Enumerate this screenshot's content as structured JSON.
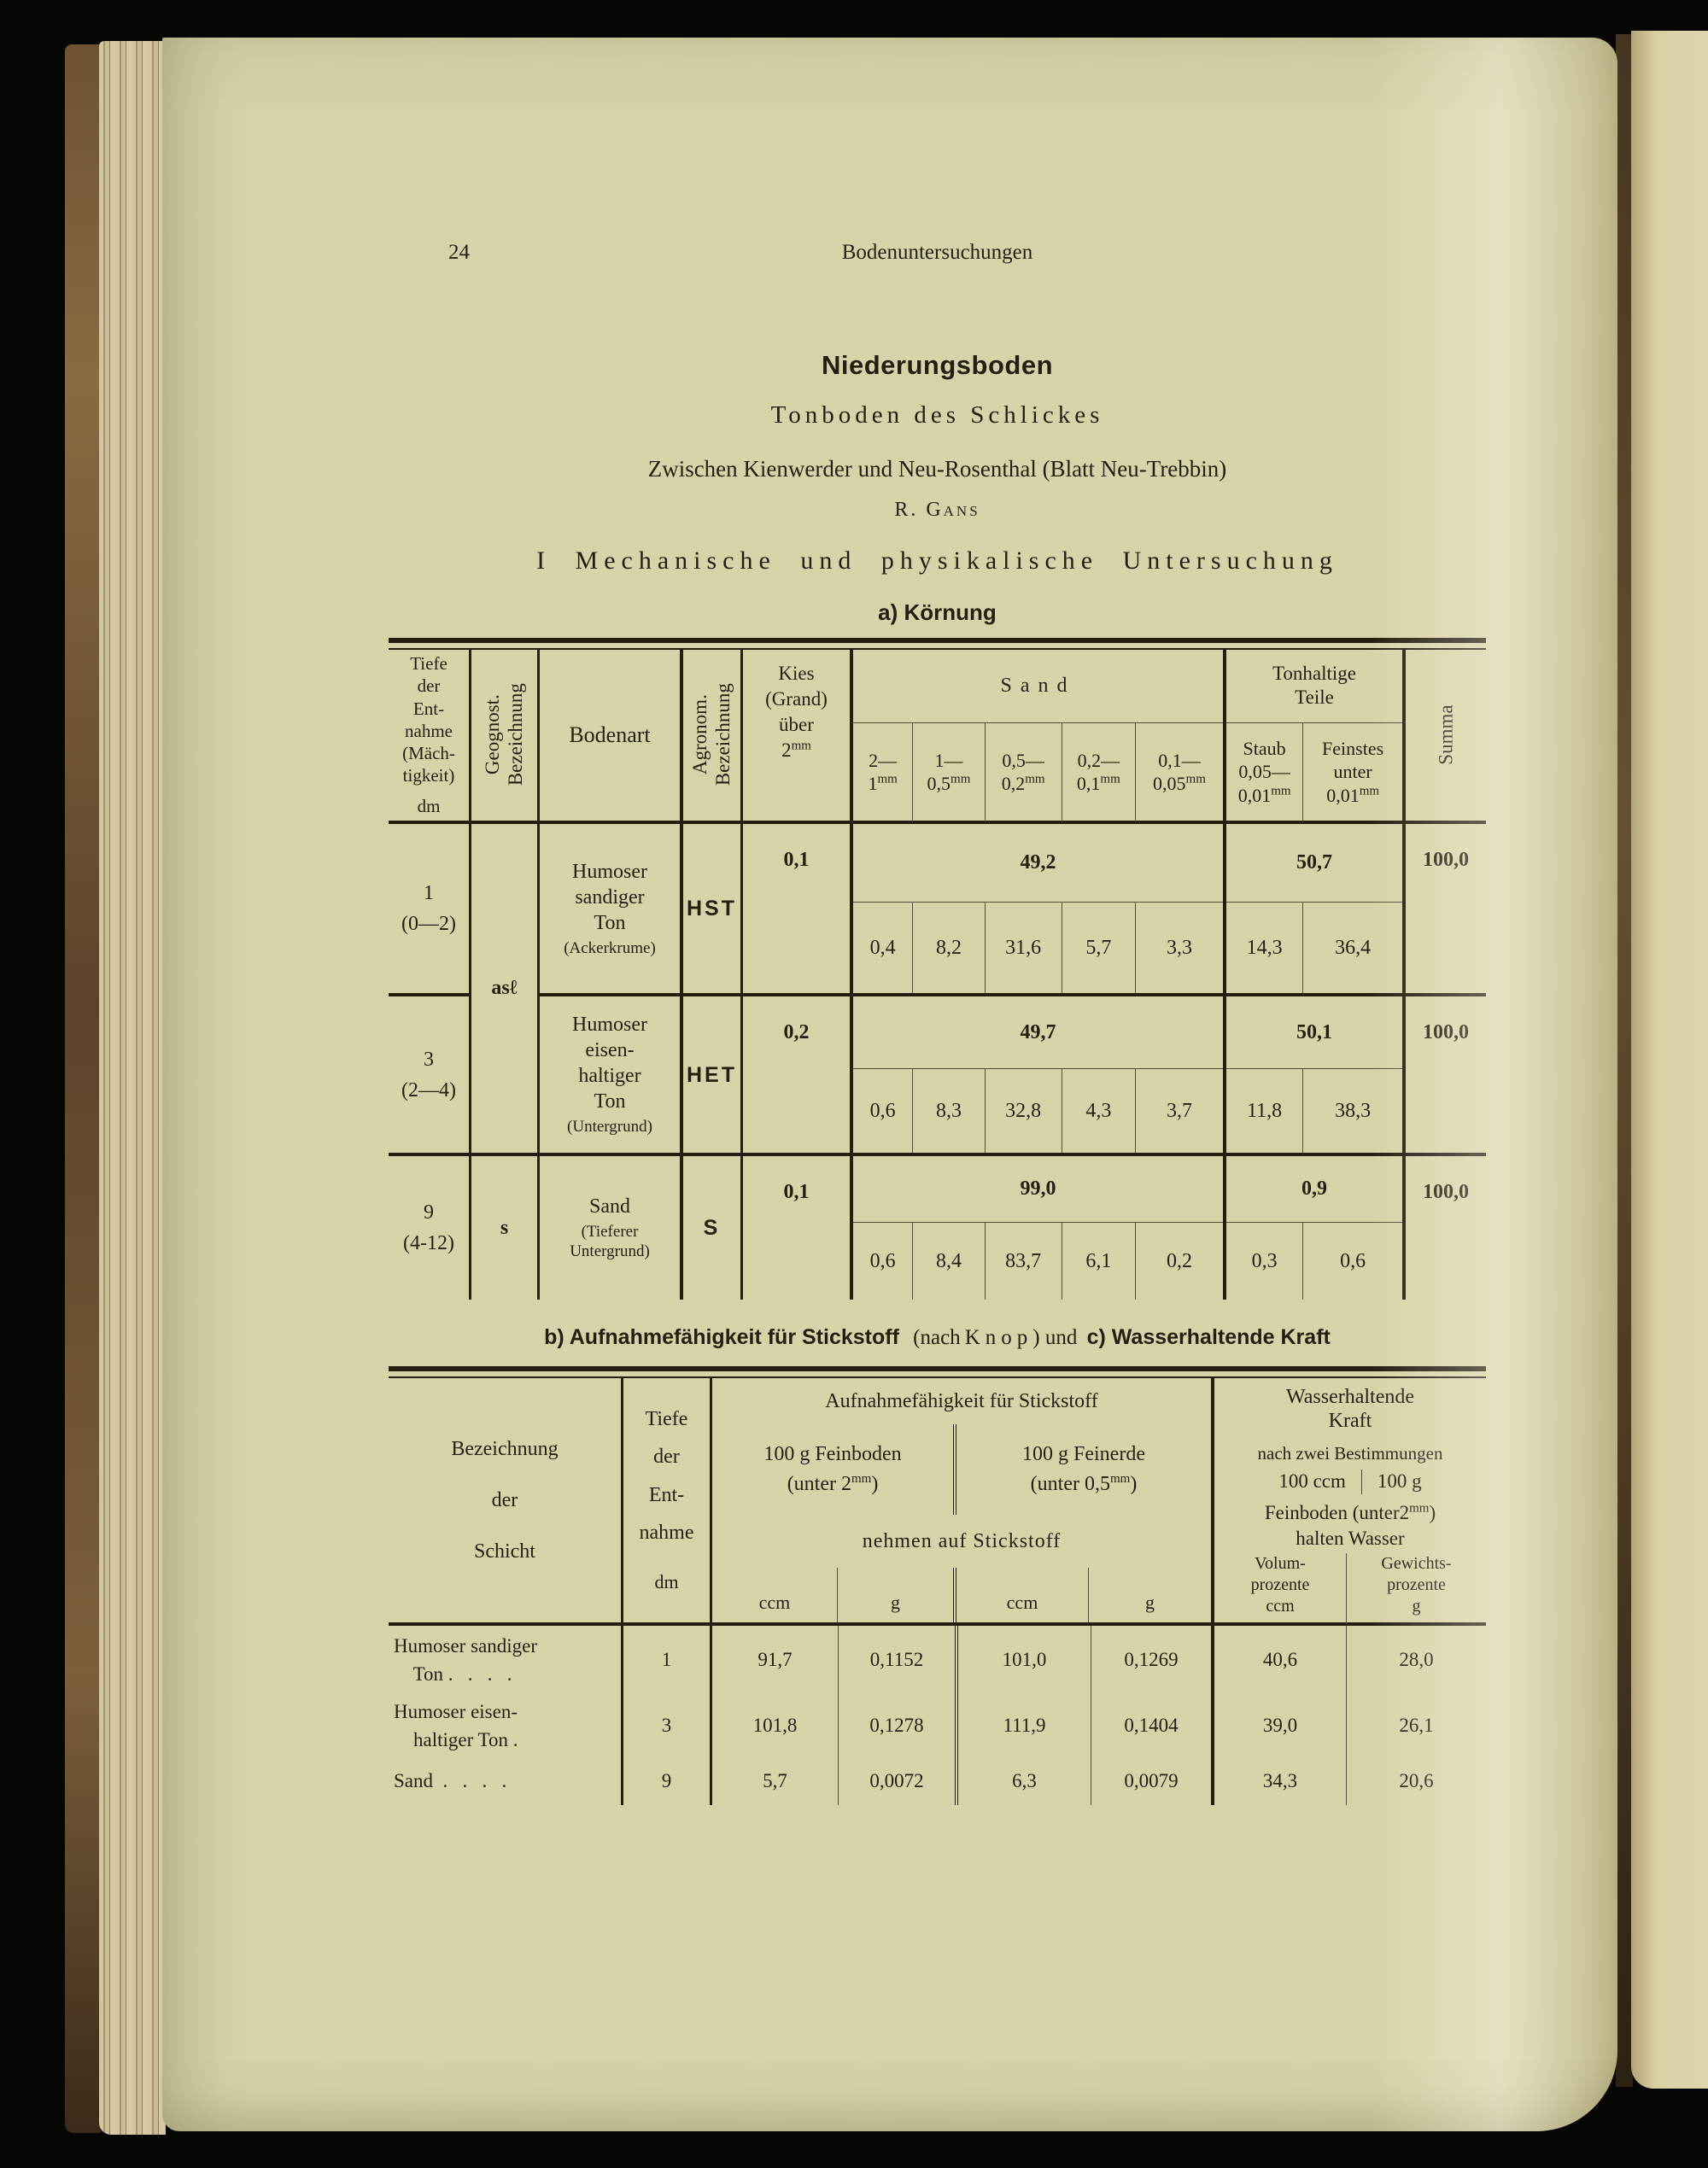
{
  "colors": {
    "paper": "#d7d3a8",
    "ink": "#241f12",
    "background": "#060605",
    "spine_brown": "#7a5c38",
    "page_edges": "#cfc29a",
    "facing_page": "#d9d0a6"
  },
  "page": {
    "number": "24",
    "running_header": "Bodenuntersuchungen",
    "title": "Niederungsboden",
    "subtitle": "Tonboden des Schlickes",
    "location": "Zwischen Kienwerder und Neu-Rosenthal (Blatt Neu-Trebbin)",
    "author": "R. Gans",
    "section_heading": "I Mechanische und physikalische Untersuchung",
    "subsection_a": "a) Körnung",
    "caption_bc": {
      "b_part": "b) Aufnahmefähigkeit für Stickstoff",
      "mid1": "(nach",
      "knop": "Knop",
      "mid2": ") und",
      "c_part": "c) Wasserhaltende Kraft"
    }
  },
  "kornung_table": {
    "headers": {
      "tiefe_lines": "Tiefe\nder\nEnt-\nnahme\n(Mäch-\ntigkeit)",
      "tiefe_unit": "dm",
      "geognost": "Geognost.\nBezeichnung",
      "bodenart": "Bodenart",
      "agronom": "Agronom.\nBezeichnung",
      "kies_lines": "Kies\n(Grand)\nüber",
      "kies_num": "2",
      "kies_unit": "mm",
      "sand_group": "Sand",
      "sand_cols": [
        {
          "range": "2—",
          "num": "1",
          "unit": "mm"
        },
        {
          "range": "1—",
          "num": "0,5",
          "unit": "mm"
        },
        {
          "range": "0,5—",
          "num": "0,2",
          "unit": "mm"
        },
        {
          "range": "0,2—",
          "num": "0,1",
          "unit": "mm"
        },
        {
          "range": "0,1—",
          "num": "0,05",
          "unit": "mm"
        }
      ],
      "ton_group": "Tonhaltige\nTeile",
      "ton_cols": [
        {
          "l1": "Staub",
          "l2": "0,05—",
          "num": "0,01",
          "unit": "mm"
        },
        {
          "l1": "Feinstes",
          "l2": "unter",
          "num": "0,01",
          "unit": "mm"
        }
      ],
      "summa": "Summa"
    },
    "rows": [
      {
        "tiefe": "1\n(0—2)",
        "geognost": "asℓ",
        "bodenart": "Humoser\nsandiger\nTon",
        "bodenart_note": "(Ackerkrume)",
        "agronom": "HST",
        "kies": "0,1",
        "sand_total": "49,2",
        "sand": [
          "0,4",
          "8,2",
          "31,6",
          "5,7",
          "3,3"
        ],
        "ton_total": "50,7",
        "ton": [
          "14,3",
          "36,4"
        ],
        "summa": "100,0"
      },
      {
        "tiefe": "3\n(2—4)",
        "geognost": "",
        "bodenart": "Humoser\neisen-\nhaltiger\nTon",
        "bodenart_note": "(Untergrund)",
        "agronom": "HET",
        "kies": "0,2",
        "sand_total": "49,7",
        "sand": [
          "0,6",
          "8,3",
          "32,8",
          "4,3",
          "3,7"
        ],
        "ton_total": "50,1",
        "ton": [
          "11,8",
          "38,3"
        ],
        "summa": "100,0"
      },
      {
        "tiefe": "9\n(4-12)",
        "geognost": "s",
        "bodenart": "Sand",
        "bodenart_note": "(Tieferer\nUntergrund)",
        "agronom": "S",
        "kies": "0,1",
        "sand_total": "99,0",
        "sand": [
          "0,6",
          "8,4",
          "83,7",
          "6,1",
          "0,2"
        ],
        "ton_total": "0,9",
        "ton": [
          "0,3",
          "0,6"
        ],
        "summa": "100,0"
      }
    ]
  },
  "stickstoff_table": {
    "headers": {
      "bezeichnung": "Bezeichnung\nder\nSchicht",
      "tiefe_lines": "Tiefe\nder\nEnt-\nnahme",
      "tiefe_unit": "dm",
      "stick_title": "Aufnahmefähigkeit für Stickstoff",
      "feinboden_l1": "100 g Feinboden",
      "feinboden_pre": "(unter 2",
      "feinboden_unit": "mm",
      "feinboden_post": ")",
      "feinerde_l1": "100 g Feinerde",
      "feinerde_pre": "(unter 0,5",
      "feinerde_unit": "mm",
      "feinerde_post": ")",
      "nehmen": "nehmen auf Stickstoff",
      "unit_ccm": "ccm",
      "unit_g": "g",
      "wasser_title": "Wasserhaltende\nKraft",
      "nach": "nach zwei Bestimmungen",
      "w1": "100 ccm",
      "w2": "100 g",
      "fb2_pre": "Feinboden (unter2",
      "fb2_unit": "mm",
      "fb2_post": ")",
      "halten": "halten Wasser",
      "volum": "Volum-\nprozente\nccm",
      "gewichts": "Gewichts-\nprozente\ng"
    },
    "rows": [
      {
        "name": "Humoser sandiger\n    Ton .   .   .   .",
        "tiefe": "1",
        "fb_ccm": "91,7",
        "fb_g": "0,1152",
        "fe_ccm": "101,0",
        "fe_g": "0,1269",
        "volum": "40,6",
        "gewichts": "28,0"
      },
      {
        "name": "Humoser eisen-\n    haltiger Ton .",
        "tiefe": "3",
        "fb_ccm": "101,8",
        "fb_g": "0,1278",
        "fe_ccm": "111,9",
        "fe_g": "0,1404",
        "volum": "39,0",
        "gewichts": "26,1"
      },
      {
        "name": "Sand  .   .   .   .",
        "tiefe": "9",
        "fb_ccm": "5,7",
        "fb_g": "0,0072",
        "fe_ccm": "6,3",
        "fe_g": "0,0079",
        "volum": "34,3",
        "gewichts": "20,6"
      }
    ]
  }
}
